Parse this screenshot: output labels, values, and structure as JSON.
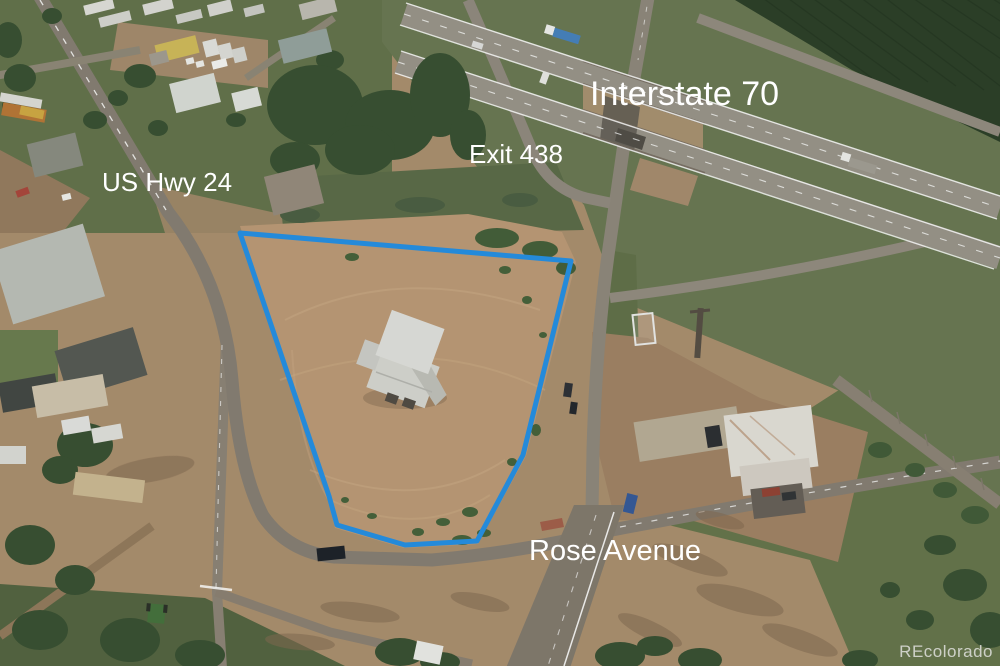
{
  "photo": {
    "description": "aerial drone photo of vacant commercial lot with blue property outline",
    "labels": {
      "interstate": "Interstate 70",
      "exit": "Exit 438",
      "us_hwy": "US Hwy 24",
      "rose_avenue": "Rose Avenue"
    },
    "watermark": "REcolorado",
    "colors": {
      "property_line": "#1d87dc",
      "label_text": "#ffffff",
      "watermark_text": "#e1e1de"
    }
  }
}
